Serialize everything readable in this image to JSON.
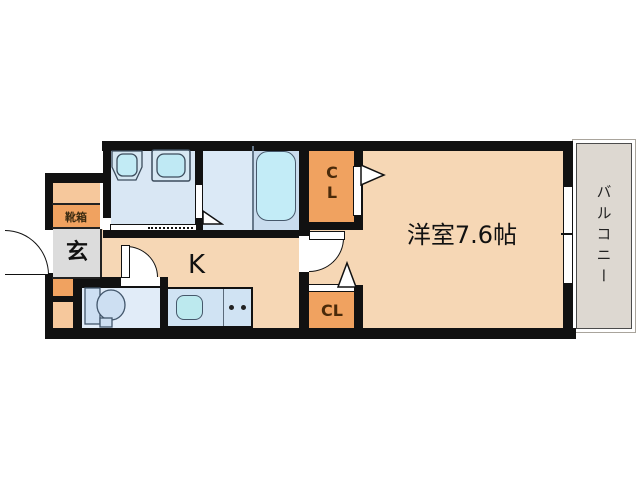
{
  "plan": {
    "type": "apartment-floor-plan",
    "rooms": {
      "main_room": {
        "label": "洋室7.6帖"
      },
      "kitchen": {
        "label": "K"
      },
      "entrance": {
        "label": "玄"
      },
      "shoe_box": {
        "label": "靴箱"
      },
      "closet_top": {
        "line1": "C",
        "line2": "L"
      },
      "closet_bottom": {
        "label": "CL"
      },
      "balcony": {
        "label": "バルコニー"
      }
    },
    "colors": {
      "wall": "#111111",
      "room_peach": "#f6d7b5",
      "closet_orange": "#f0a260",
      "accent_orange_light": "#f6c89c",
      "entrance_gray": "#dcdcdc",
      "wet_area_blue": "#d9e7f4",
      "bath_zone_blue": "#c9dcee",
      "fixture_cyan": "#c0eaf5",
      "balcony_gray": "#ddd8d1",
      "background": "#ffffff"
    }
  }
}
